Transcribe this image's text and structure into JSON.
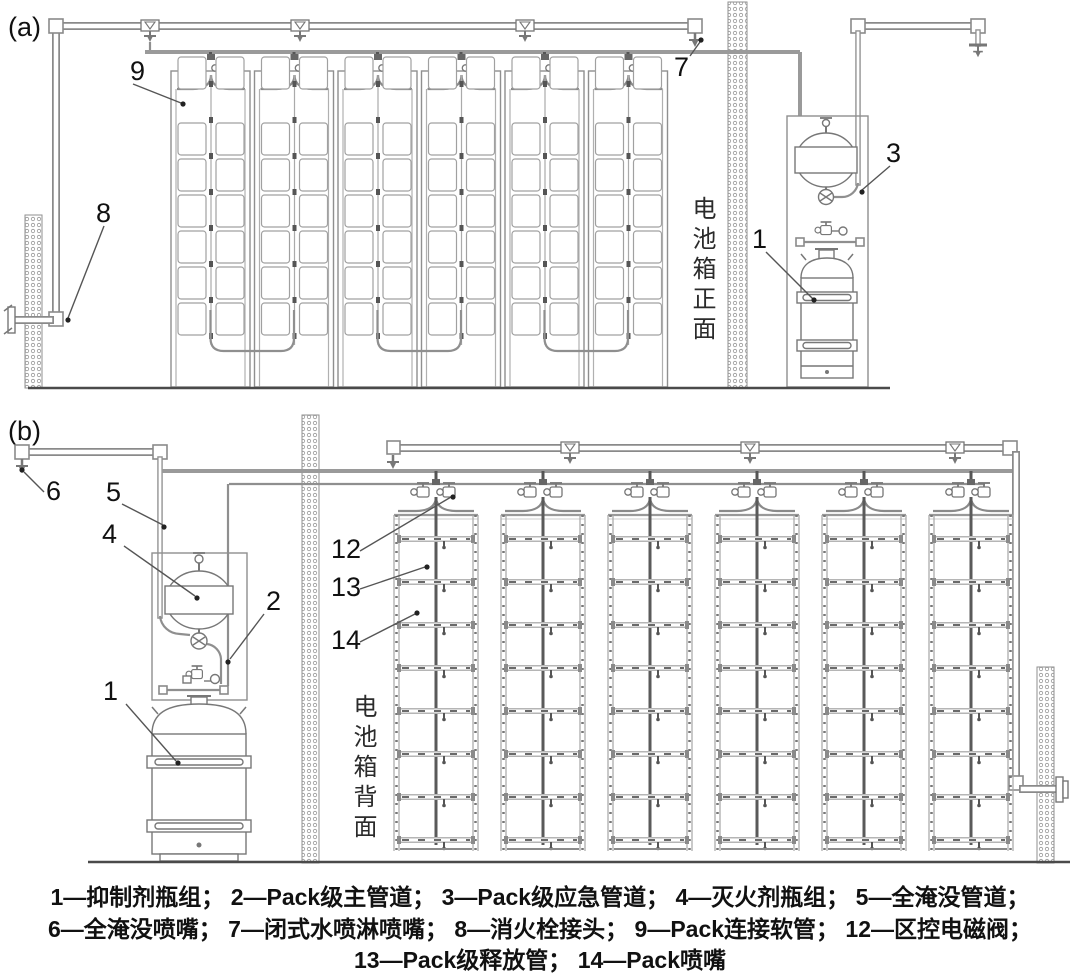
{
  "panels": {
    "a": {
      "tag": "(a)",
      "side_label": "电池箱正面",
      "callouts": {
        "c1": "1",
        "c3": "3",
        "c7": "7",
        "c8": "8",
        "c9": "9"
      }
    },
    "b": {
      "tag": "(b)",
      "side_label": "电池箱背面",
      "callouts": {
        "c1": "1",
        "c2": "2",
        "c4": "4",
        "c5": "5",
        "c6": "6",
        "c12": "12",
        "c13": "13",
        "c14": "14"
      }
    }
  },
  "legend": {
    "lines": [
      "1—抑制剂瓶组； 2—Pack级主管道； 3—Pack级应急管道； 4—灭火剂瓶组； 5—全淹没管道；",
      "6—全淹没喷嘴； 7—闭式水喷淋喷嘴； 8—消火栓接头； 9—Pack连接软管； 12—区控电磁阀；",
      "13—Pack级释放管； 14—Pack喷嘴"
    ],
    "entries": [
      {
        "id": "1",
        "label": "抑制剂瓶组"
      },
      {
        "id": "2",
        "label": "Pack级主管道"
      },
      {
        "id": "3",
        "label": "Pack级应急管道"
      },
      {
        "id": "4",
        "label": "灭火剂瓶组"
      },
      {
        "id": "5",
        "label": "全淹没管道"
      },
      {
        "id": "6",
        "label": "全淹没喷嘴"
      },
      {
        "id": "7",
        "label": "闭式水喷淋喷嘴"
      },
      {
        "id": "8",
        "label": "消火栓接头"
      },
      {
        "id": "9",
        "label": "Pack连接软管"
      },
      {
        "id": "12",
        "label": "区控电磁阀"
      },
      {
        "id": "13",
        "label": "Pack级释放管"
      },
      {
        "id": "14",
        "label": "Pack喷嘴"
      }
    ]
  },
  "colors": {
    "pipe": "#8a8a8a",
    "dark_line": "#555555",
    "text": "#111111",
    "background": "#ffffff"
  }
}
